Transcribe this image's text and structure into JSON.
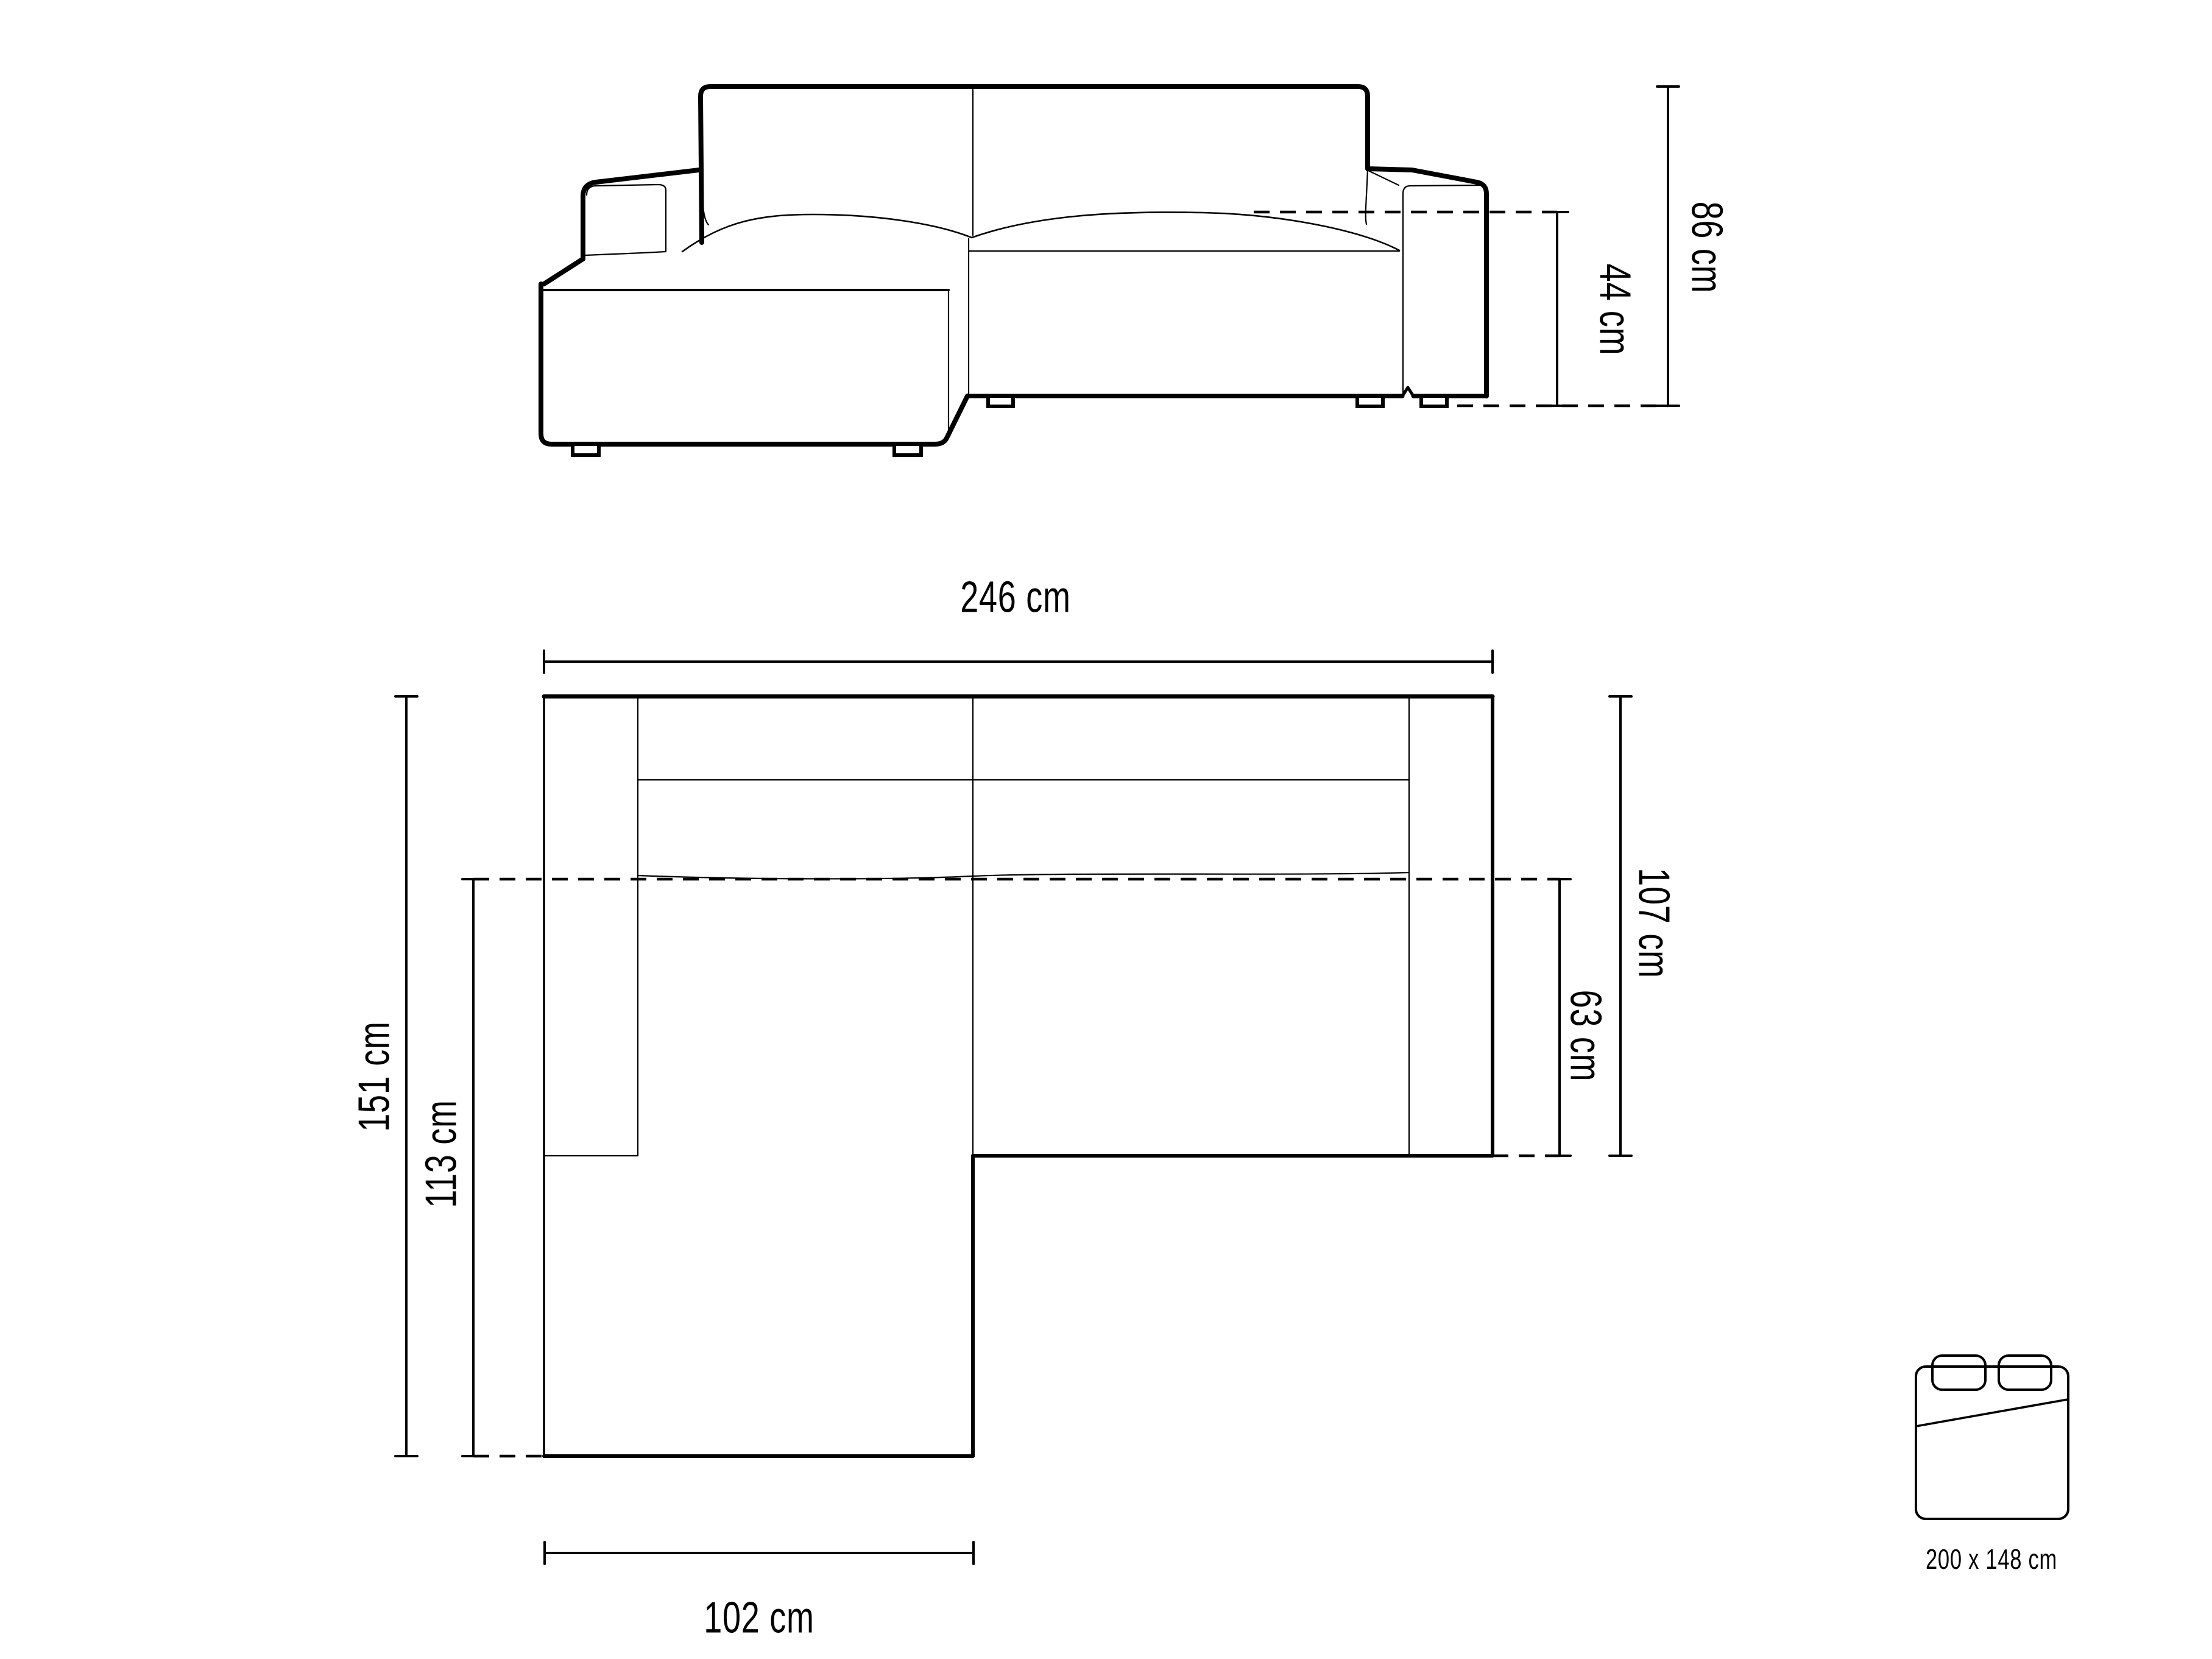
{
  "diagram_type": "corner-sofa dimensions technical drawing",
  "front_view": {
    "total_height_label": "86 cm",
    "seat_height_label": "44 cm"
  },
  "top_view": {
    "total_width_label": "246 cm",
    "total_depth_label": "151 cm",
    "chaise_depth_label": "113 cm",
    "side_depth_label": "107 cm",
    "seat_depth_label": "63 cm",
    "chaise_width_label": "102 cm"
  },
  "sleeping_area": {
    "icon": "bed-top-view-icon",
    "size_label": "200 x 148 cm"
  },
  "colors": {
    "line": "#000000",
    "background": "#ffffff"
  }
}
